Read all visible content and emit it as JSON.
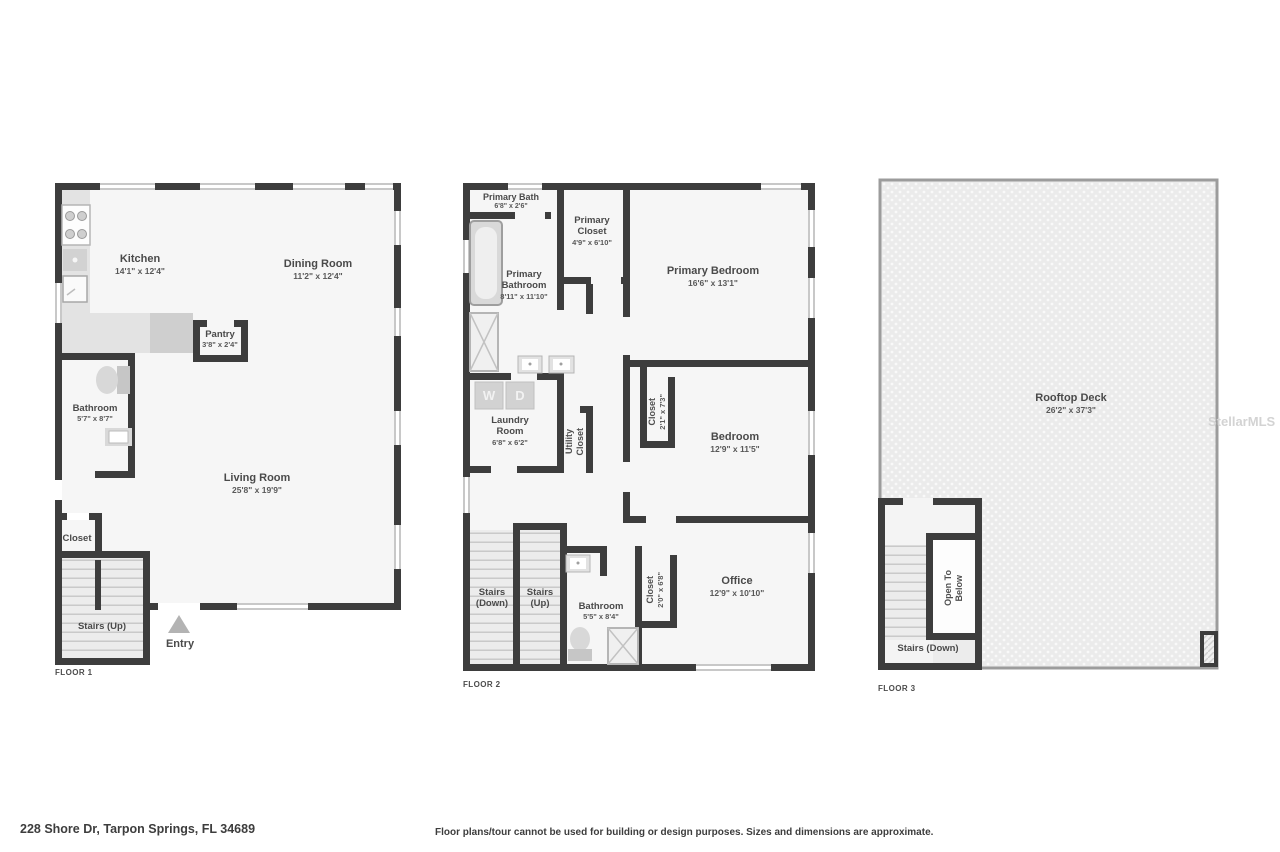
{
  "floor1": {
    "label": "FLOOR 1",
    "kitchen": {
      "name": "Kitchen",
      "dims": "14'1\" x 12'4\""
    },
    "dining": {
      "name": "Dining Room",
      "dims": "11'2\" x 12'4\""
    },
    "pantry": {
      "name": "Pantry",
      "dims": "3'8\" x 2'4\""
    },
    "bathroom": {
      "name": "Bathroom",
      "dims": "5'7\" x 8'7\""
    },
    "living": {
      "name": "Living Room",
      "dims": "25'8\" x 19'9\""
    },
    "closet": {
      "name": "Closet"
    },
    "stairs_up": {
      "name": "Stairs (Up)"
    },
    "entry": {
      "name": "Entry"
    }
  },
  "floor2": {
    "label": "FLOOR 2",
    "primary_bath": {
      "name": "Primary Bath",
      "dims": "6'8\" x 2'6\""
    },
    "primary_closet": {
      "name": "Primary Closet",
      "dims": "4'9\" x 6'10\""
    },
    "primary_bedroom": {
      "name": "Primary Bedroom",
      "dims": "16'6\" x 13'1\""
    },
    "primary_bathroom": {
      "name": "Primary Bathroom",
      "dims": "8'11\" x 11'10\""
    },
    "laundry": {
      "name": "Laundry Room",
      "dims": "6'8\" x 6'2\""
    },
    "utility_closet": {
      "line1": "Utility",
      "line2": "Closet"
    },
    "bedroom_closet": {
      "name": "Closet",
      "dims": "2'1\" x 7'3\""
    },
    "bedroom": {
      "name": "Bedroom",
      "dims": "12'9\" x 11'5\""
    },
    "stairs_down": {
      "line1": "Stairs",
      "line2": "(Down)"
    },
    "stairs_up": {
      "line1": "Stairs",
      "line2": "(Up)"
    },
    "bathroom": {
      "name": "Bathroom",
      "dims": "5'5\" x 8'4\""
    },
    "office_closet": {
      "name": "Closet",
      "dims": "2'0\" x 6'8\""
    },
    "office": {
      "name": "Office",
      "dims": "12'9\" x 10'10\""
    },
    "washer": "W",
    "dryer": "D"
  },
  "floor3": {
    "label": "FLOOR 3",
    "rooftop": {
      "name": "Rooftop Deck",
      "dims": "26'2\" x 37'3\""
    },
    "open_below": {
      "line1": "Open To",
      "line2": "Below"
    },
    "stairs_down": {
      "name": "Stairs (Down)"
    },
    "watermark": "StellarMLS"
  },
  "footer": {
    "address": "228 Shore Dr, Tarpon Springs, FL 34689",
    "disclaimer": "Floor plans/tour cannot be used for building or design purposes. Sizes and dimensions are approximate."
  },
  "colors": {
    "wall": "#3d3d3d",
    "window": "#c8c8c8",
    "fixture": "#d6d6d6",
    "text": "#4a4a4a"
  }
}
